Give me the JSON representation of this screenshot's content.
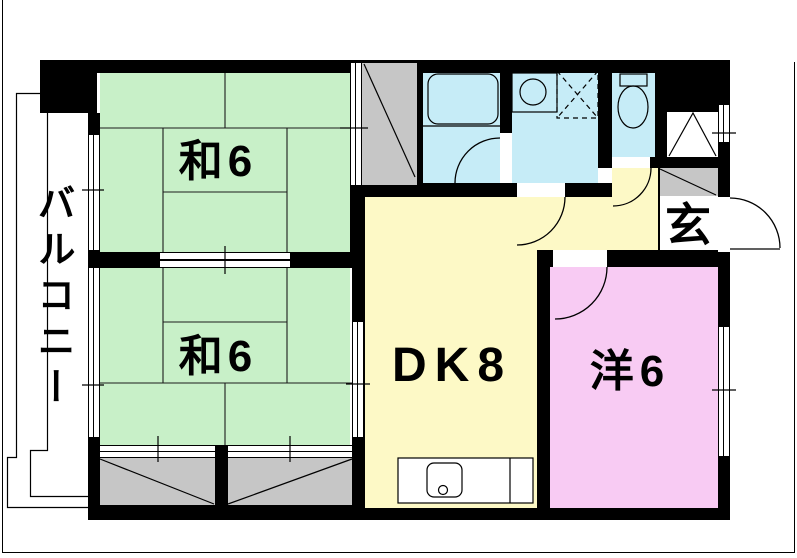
{
  "plan": {
    "labels": {
      "balcony": "バルコニー",
      "japanese_room_upper": "和6",
      "japanese_room_lower": "和6",
      "dining_kitchen": "DK8",
      "western_room": "洋6",
      "entrance": "玄"
    },
    "colors": {
      "wall": "#000000",
      "tatami-green": "#c8f0c8",
      "dk-yellow": "#fdf9c6",
      "wet-cyan": "#c6ecf7",
      "western-pink": "#f8cbf3",
      "closet-gray": "#c6c6c6"
    },
    "fixtures": [
      "bathtub-icon",
      "washbasin-icon",
      "washing-machine-pan-icon",
      "toilet-icon",
      "kitchen-sink-icon"
    ]
  }
}
